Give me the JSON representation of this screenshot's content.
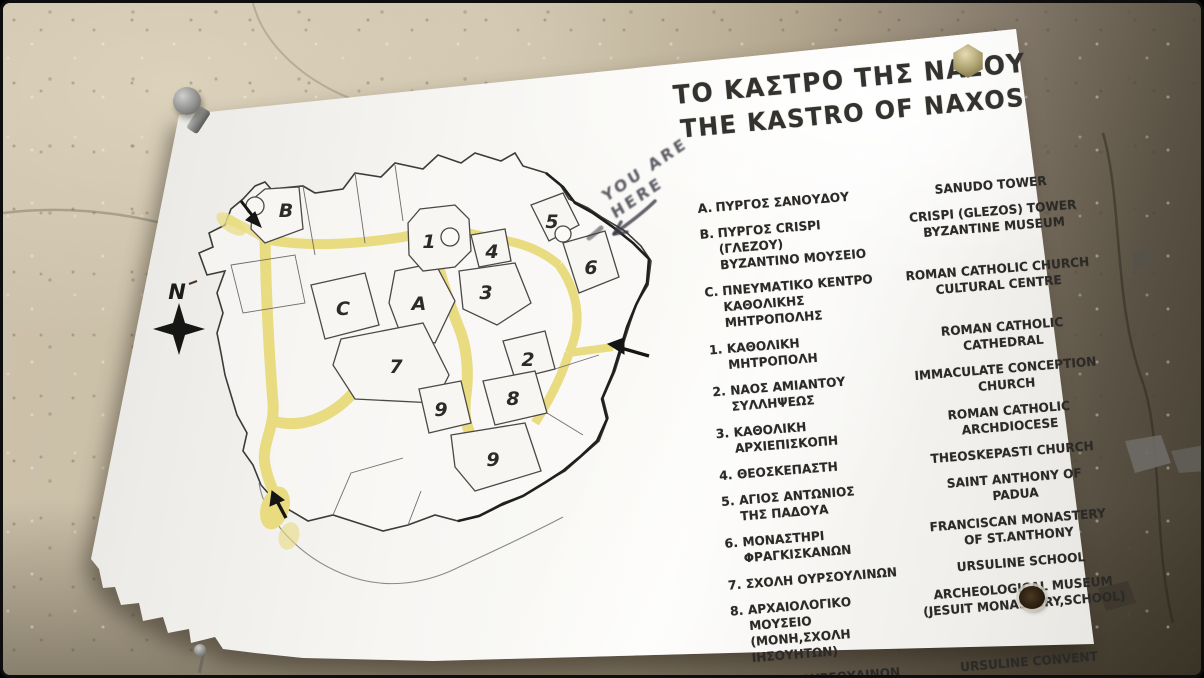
{
  "colors": {
    "street_yellow": "#e8db80",
    "sign_white": "#f6f5f1",
    "ink": "#2c2a27",
    "wall_light": "#cdc2ab",
    "wall_dark": "#433d30",
    "bolt_silver": "#8f8f8d",
    "nut_brass": "#a69a68"
  },
  "title": {
    "line1_gr": "ΤΟ ΚΑΣΤΡΟ ΤΗΣ ΝΑΞΟΥ",
    "line2_en": "THE KASTRO OF NAXOS"
  },
  "legend": {
    "items": [
      {
        "id": "A.",
        "gr": "ΠΥΡΓΟΣ ΣΑΝΟΥΔΟΥ",
        "en": "SANUDO TOWER"
      },
      {
        "id": "B.",
        "gr": "ΠΥΡΓΟΣ CRISPI (ΓΛΕΖΟΥ)\nΒΥΖΑΝΤΙΝΟ ΜΟΥΣΕΙΟ",
        "en": "CRISPI (GLEZOS) TOWER\nBYZANTINE MUSEUM"
      },
      {
        "id": "C.",
        "gr": "ΠΝΕΥΜΑΤΙΚΟ ΚΕΝΤΡΟ\nΚΑΘΟΛΙΚΗΣ ΜΗΤΡΟΠΟΛΗΣ",
        "en": "ROMAN CATHOLIC CHURCH\nCULTURAL CENTRE"
      },
      {
        "id": "1.",
        "gr": "ΚΑΘΟΛΙΚΗ ΜΗΤΡΟΠΟΛΗ",
        "en": "ROMAN CATHOLIC CATHEDRAL"
      },
      {
        "id": "2.",
        "gr": "ΝΑΟΣ ΑΜΙΑΝΤΟΥ\nΣΥΛΛΗΨΕΩΣ",
        "en": "IMMACULATE CONCEPTION\nCHURCH"
      },
      {
        "id": "3.",
        "gr": "ΚΑΘΟΛΙΚΗ ΑΡΧΙΕΠΙΣΚΟΠΗ",
        "en": "ROMAN CATHOLIC ARCHDIOCESE"
      },
      {
        "id": "4.",
        "gr": "ΘΕΟΣΚΕΠΑΣΤΗ",
        "en": "THEOSKEPASTI CHURCH"
      },
      {
        "id": "5.",
        "gr": "ΑΓΙΟΣ ΑΝΤΩΝΙΟΣ\nΤΗΣ ΠΑΔΟΥΑ",
        "en": "SAINT ANTHONY OF\nPADUA"
      },
      {
        "id": "6.",
        "gr": "ΜΟΝΑΣΤΗΡΙ\nΦΡΑΓΚΙΣΚΑΝΩΝ",
        "en": "FRANCISCAN MONASTERY\nOF ST.ANTHONY"
      },
      {
        "id": "7.",
        "gr": "ΣΧΟΛΗ ΟΥΡΣΟΥΛΙΝΩΝ",
        "en": "URSULINE SCHOOL"
      },
      {
        "id": "8.",
        "gr": "ΑΡΧΑΙΟΛΟΓΙΚΟ ΜΟΥΣΕΙΟ\n(ΜΟΝΗ,ΣΧΟΛΗ ΙΗΣΟΥΗΤΩΝ)",
        "en": "ARCHEOLOGICAL MUSEUM\n(JESUIT MONASTERY,SCHOOL)"
      },
      {
        "id": "9.",
        "gr": "ΜΟΝΗ ΟΥΡΣΟΥΛΙΝΩΝ",
        "en": "URSULINE CONVENT"
      }
    ]
  },
  "map": {
    "compass_label": "N",
    "labels": [
      {
        "text": "B"
      },
      {
        "text": "C"
      },
      {
        "text": "A"
      },
      {
        "text": "1"
      },
      {
        "text": "4"
      },
      {
        "text": "3"
      },
      {
        "text": "5"
      },
      {
        "text": "6"
      },
      {
        "text": "7"
      },
      {
        "text": "9"
      },
      {
        "text": "2"
      },
      {
        "text": "8"
      },
      {
        "text": "9"
      }
    ]
  },
  "graffiti": {
    "text": "YOU ARE\nHERE"
  }
}
